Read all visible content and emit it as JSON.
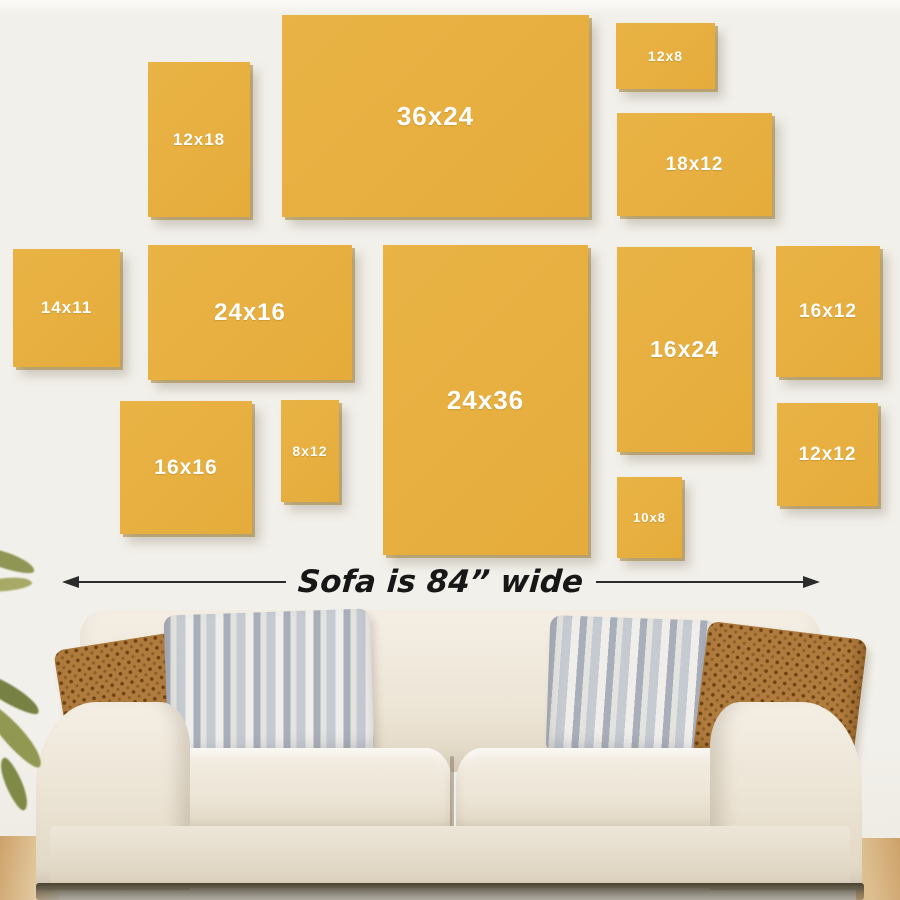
{
  "scene": {
    "wall_color": "#F2F0EA",
    "wall_top_highlight": "#FCFBF8",
    "frame_color": "#E9B345",
    "frame_edge_color": "#A48030",
    "frame_label_color": "#FFFFFF"
  },
  "frames": [
    {
      "label": "12x18",
      "x": 148,
      "y": 62,
      "w": 102,
      "h": 155,
      "fs": 17
    },
    {
      "label": "36x24",
      "x": 282,
      "y": 15,
      "w": 307,
      "h": 202,
      "fs": 26
    },
    {
      "label": "12x8",
      "x": 616,
      "y": 23,
      "w": 99,
      "h": 66,
      "fs": 14
    },
    {
      "label": "18x12",
      "x": 617,
      "y": 113,
      "w": 155,
      "h": 103,
      "fs": 19
    },
    {
      "label": "14x11",
      "x": 13,
      "y": 249,
      "w": 107,
      "h": 118,
      "fs": 17
    },
    {
      "label": "24x16",
      "x": 148,
      "y": 245,
      "w": 204,
      "h": 135,
      "fs": 24
    },
    {
      "label": "24x36",
      "x": 383,
      "y": 245,
      "w": 205,
      "h": 310,
      "fs": 26
    },
    {
      "label": "16x24",
      "x": 617,
      "y": 247,
      "w": 135,
      "h": 205,
      "fs": 23
    },
    {
      "label": "16x12",
      "x": 776,
      "y": 246,
      "w": 104,
      "h": 131,
      "fs": 19
    },
    {
      "label": "16x16",
      "x": 120,
      "y": 401,
      "w": 132,
      "h": 133,
      "fs": 21
    },
    {
      "label": "8x12",
      "x": 281,
      "y": 400,
      "w": 58,
      "h": 102,
      "fs": 14
    },
    {
      "label": "10x8",
      "x": 617,
      "y": 477,
      "w": 65,
      "h": 81,
      "fs": 13
    },
    {
      "label": "12x12",
      "x": 777,
      "y": 403,
      "w": 101,
      "h": 103,
      "fs": 19
    }
  ],
  "dimension": {
    "text": "Sofa is 84” wide",
    "line_color": "#2B2B2B"
  },
  "sofa": {
    "fabric_light": "#F4EEE4",
    "fabric_mid": "#EDE5D6",
    "fabric_dark": "#DFD5C2",
    "pillow_rust": "#B07C3E",
    "pillow_rust_dot": "#6E4214",
    "pillow_stripe_light": "#E3E3DF",
    "pillow_stripe_dark": "#A9AFBA",
    "floor_wood": "#CDA26A",
    "under_shadow": "#4A4231",
    "plant_leaf": "#8A914C",
    "pillow_arrangement": [
      "rust-dotted",
      "gray-striped",
      "gray-striped",
      "rust-dotted"
    ]
  }
}
